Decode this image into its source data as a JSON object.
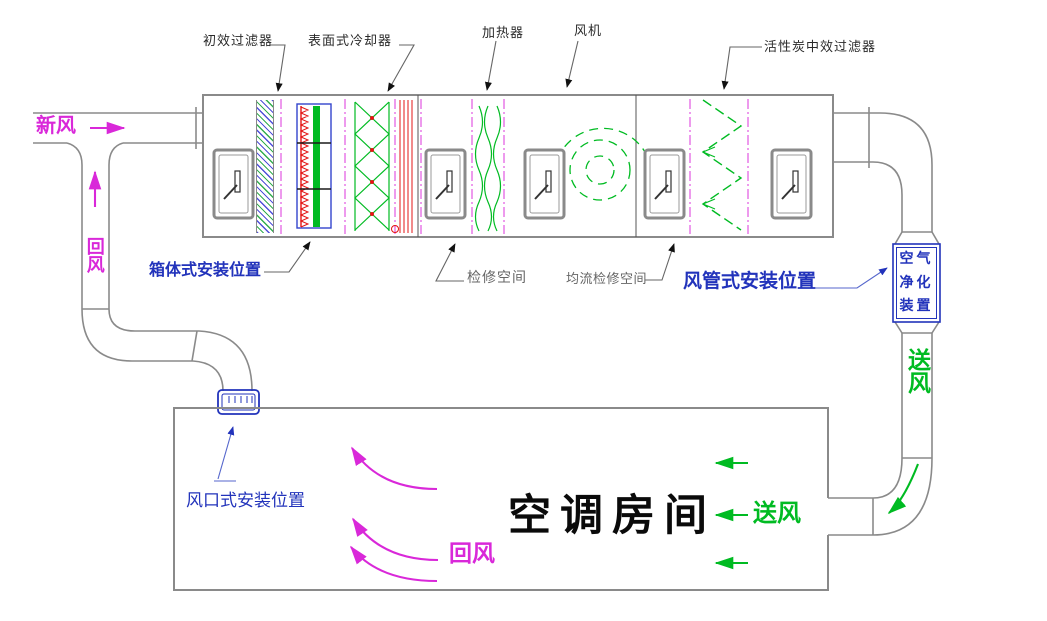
{
  "colors": {
    "magenta": "#d928d9",
    "green": "#00bb22",
    "blue": "#2233bb",
    "red": "#e31414",
    "outline": "#8a8a8a",
    "gray": "#666666"
  },
  "ahu": {
    "top_labels": {
      "primary_filter": "初效过滤器",
      "surface_cooler": "表面式冷却器",
      "heater": "加热器",
      "fan": "风机",
      "carbon_filter": "活性炭中效过滤器"
    },
    "bottom_labels": {
      "cabinet_install": "箱体式安装位置",
      "service_space": "检修空间",
      "flow_service_space": "均流检修空间",
      "duct_install": "风管式安装位置"
    }
  },
  "left_duct": {
    "fresh_air": "新风",
    "return_air": "回风"
  },
  "right_duct": {
    "purifier_line1": "空气",
    "purifier_line2": "净化",
    "purifier_line3": "装置",
    "supply_air": "送风"
  },
  "room": {
    "name": "空调房间",
    "return_air": "回风",
    "supply_air": "送风",
    "grille_install": "风口式安装位置"
  }
}
